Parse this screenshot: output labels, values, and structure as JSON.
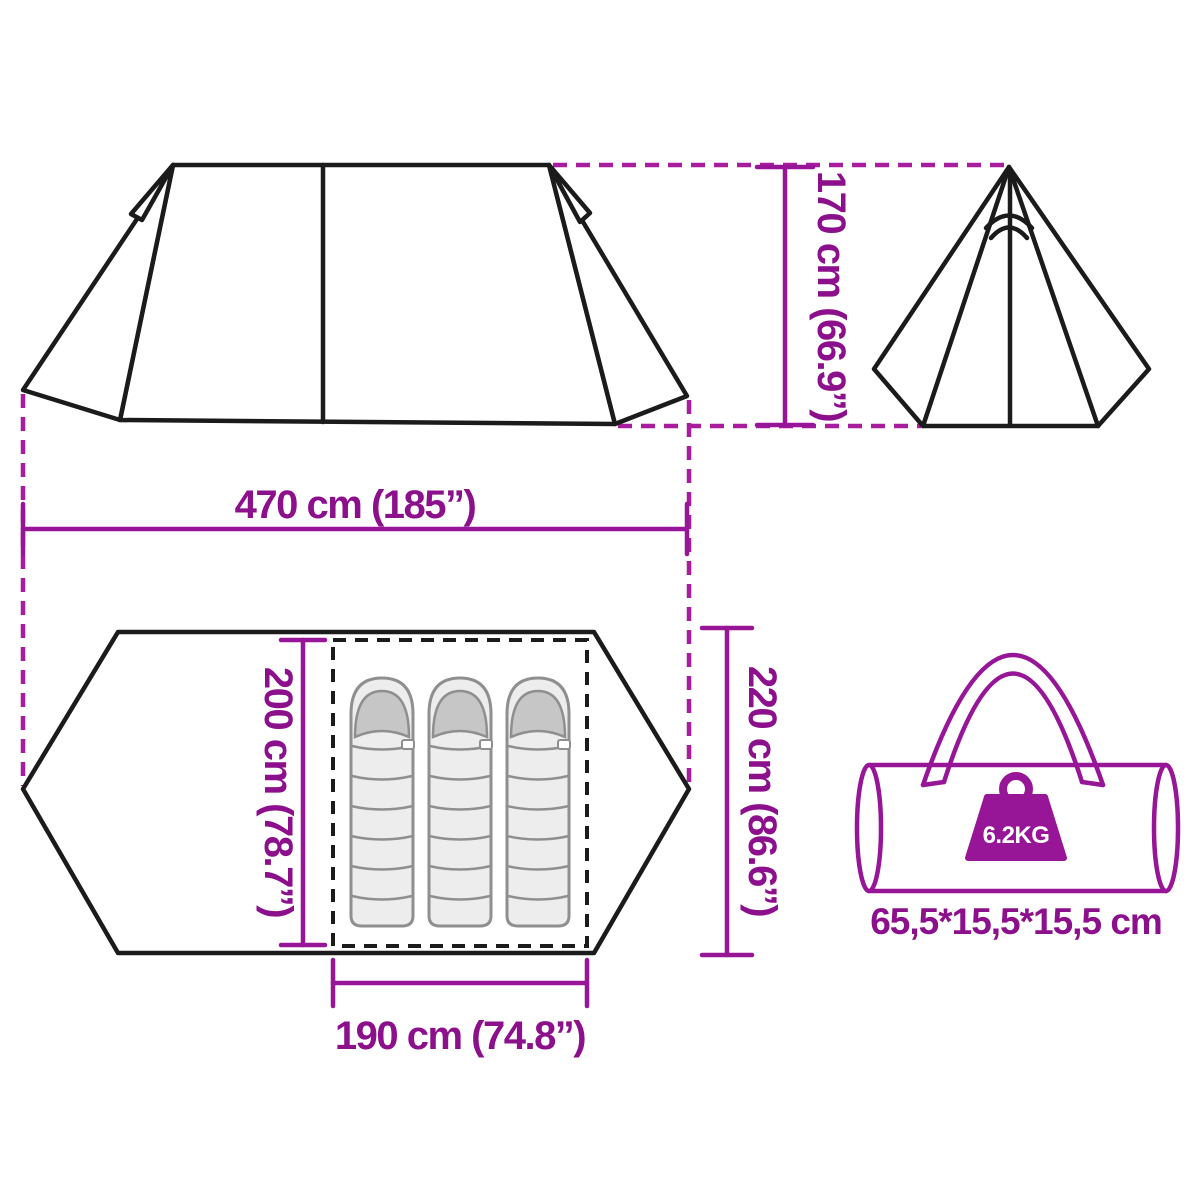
{
  "page": {
    "type": "product-dimension-diagram",
    "subject": "family-tipi-tent-3-person",
    "background": "#ffffff"
  },
  "colors": {
    "outline_black": "#1b1b1b",
    "accent_line": "#971597",
    "accent_dash": "#a81c9e",
    "accent_text": "#8c108c",
    "bag_fill": "#ededed",
    "bag_hood": "#c6c6c6",
    "bag_outline": "#8f8f8f",
    "weight_label_text": "#ffffff"
  },
  "views": {
    "side_view": "tent side elevation",
    "front_view": "tent front elevation (tipi)",
    "top_view": "tent floor plan",
    "sleeping_bags_count": 3
  },
  "dimensions": {
    "height": "170 cm (66.9”)",
    "length": "470 cm (185”)",
    "inner_width": "200 cm (78.7”)",
    "outer_width": "220 cm (86.6”)",
    "inner_length": "190 cm (74.8”)"
  },
  "package": {
    "weight": "6.2KG",
    "size": "65,5*15,5*15,5 cm"
  },
  "icons": {
    "weight": "weight-kettlebell-icon",
    "bag": "carry-bag-icon"
  }
}
